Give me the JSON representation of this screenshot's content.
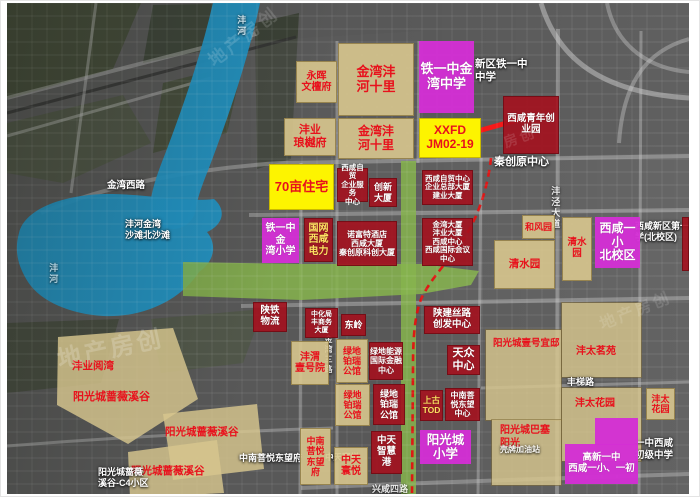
{
  "meta": {
    "title": "金湾片区规划卫星图",
    "width": 700,
    "height": 497
  },
  "colors": {
    "water": "#2293c4",
    "green": "#86b44c",
    "tan_parcel": "#d8c78e",
    "red_parcel": "#a4111e",
    "magenta_school": "#d32fd4",
    "yellow_highlight": "#fdf400",
    "red_text": "#e8111c",
    "dashed_route": "#e31010",
    "arrow": "#f51515",
    "yellow_text": "#ffe162"
  },
  "watermark_text": "地产房创",
  "parcels": [
    {
      "name": "parcel-yonghui-wentanfu",
      "type": "tan",
      "x": 295,
      "y": 60,
      "w": 41,
      "h": 42,
      "fs": 10,
      "text": "永晖\n文檀府"
    },
    {
      "name": "parcel-jinwan-fenghe-shili-north",
      "type": "tan",
      "x": 337,
      "y": 42,
      "w": 76,
      "h": 73,
      "fs": 13,
      "text": "金湾沣\n河十里"
    },
    {
      "name": "parcel-tieyizhong-jinwan-middle-school",
      "type": "magenta",
      "x": 418,
      "y": 40,
      "w": 55,
      "h": 72,
      "fs": 13,
      "text": "铁一中金\n湾中学"
    },
    {
      "name": "parcel-fengye-langyuefu",
      "type": "tan",
      "x": 283,
      "y": 117,
      "w": 52,
      "h": 38,
      "fs": 11,
      "text": "沣业\n琅樾府"
    },
    {
      "name": "parcel-jinwan-fenghe-shili-south",
      "type": "tan",
      "x": 337,
      "y": 117,
      "w": 76,
      "h": 41,
      "fs": 12,
      "text": "金湾沣\n河十里"
    },
    {
      "name": "parcel-xxfd-jm02-19",
      "type": "yellow",
      "x": 418,
      "y": 117,
      "w": 62,
      "h": 40,
      "fs": 12,
      "text": "XXFD\nJM02-19"
    },
    {
      "name": "parcel-xixian-youth-park",
      "type": "red",
      "x": 502,
      "y": 95,
      "w": 56,
      "h": 58,
      "fs": 9.5,
      "text": "西咸青年创\n业园"
    },
    {
      "name": "parcel-70mu-residential",
      "type": "yellow",
      "x": 268,
      "y": 163,
      "w": 65,
      "h": 46,
      "fs": 13,
      "text": "70亩住宅"
    },
    {
      "name": "parcel-zimao-service-center",
      "type": "red",
      "x": 336,
      "y": 167,
      "w": 31,
      "h": 34,
      "fs": 7.5,
      "text": "西咸自贸\n企业服务\n中心"
    },
    {
      "name": "parcel-chuangxin-tower",
      "type": "red",
      "x": 368,
      "y": 177,
      "w": 28,
      "h": 29,
      "fs": 9,
      "text": "创新\n大厦"
    },
    {
      "name": "parcel-zimao-center",
      "type": "red",
      "x": 421,
      "y": 169,
      "w": 51,
      "h": 35,
      "fs": 7.5,
      "text": "西咸自贸中心\n企业总部大厦\n建业大厦"
    },
    {
      "name": "parcel-tieyizhong-jinwan-primary",
      "type": "magenta",
      "x": 261,
      "y": 217,
      "w": 37,
      "h": 45,
      "fs": 10,
      "text": "铁一中金\n湾小学"
    },
    {
      "name": "parcel-guowang-xixian-power",
      "type": "red",
      "x": 303,
      "y": 217,
      "w": 29,
      "h": 44,
      "fs": 10,
      "tc": "#ffe162",
      "text": "国网\n西咸\n电力"
    },
    {
      "name": "parcel-novotel-block",
      "type": "red",
      "x": 336,
      "y": 220,
      "w": 60,
      "h": 45,
      "fs": 8,
      "text": "诺富特酒店\n西咸大厦\n秦创原科创大厦"
    },
    {
      "name": "parcel-jinwan-tower-block",
      "type": "red",
      "x": 421,
      "y": 217,
      "w": 51,
      "h": 48,
      "fs": 7.5,
      "text": "金湾大厦\n沣业大厦\n西咸中心\n西咸国际会议中心"
    },
    {
      "name": "parcel-hefengyuan",
      "type": "tan",
      "x": 521,
      "y": 214,
      "w": 33,
      "h": 24,
      "fs": 9,
      "text": "和风园"
    },
    {
      "name": "parcel-qingshuiyuan-west",
      "type": "tan",
      "x": 493,
      "y": 239,
      "w": 61,
      "h": 49,
      "fs": 10.5,
      "text": "清水园"
    },
    {
      "name": "parcel-qingshuiyuan-east",
      "type": "tan",
      "x": 561,
      "y": 216,
      "w": 30,
      "h": 64,
      "fs": 9.5,
      "text": "清水园"
    },
    {
      "name": "parcel-xixian-yixiao-north-campus",
      "type": "magenta",
      "x": 594,
      "y": 216,
      "w": 45,
      "h": 51,
      "fs": 12,
      "text": "西咸一小\n北校区"
    },
    {
      "name": "parcel-shaantie-logistics",
      "type": "red",
      "x": 252,
      "y": 301,
      "w": 34,
      "h": 30,
      "fs": 9.5,
      "text": "陕铁\n物流"
    },
    {
      "name": "parcel-zhonghuaju-tower",
      "type": "red",
      "x": 304,
      "y": 307,
      "w": 33,
      "h": 30,
      "fs": 7,
      "text": "中化局\n丰商务\n大厦"
    },
    {
      "name": "parcel-dongling",
      "type": "red",
      "x": 340,
      "y": 313,
      "w": 25,
      "h": 22,
      "fs": 9,
      "text": "东岭"
    },
    {
      "name": "parcel-fengwei-yihaoyuan",
      "type": "tan",
      "x": 290,
      "y": 340,
      "w": 38,
      "h": 44,
      "fs": 10,
      "text": "沣渭\n壹号院"
    },
    {
      "name": "parcel-lvdi-borui-1",
      "type": "tan",
      "x": 335,
      "y": 338,
      "w": 32,
      "h": 44,
      "fs": 9,
      "text": "绿地\n铂瑞\n公馆"
    },
    {
      "name": "parcel-lvdi-energy-center",
      "type": "red",
      "x": 368,
      "y": 341,
      "w": 34,
      "h": 38,
      "fs": 8,
      "text": "绿地能源\n国际金融\n中心"
    },
    {
      "name": "parcel-lvdi-borui-2",
      "type": "tan",
      "x": 334,
      "y": 383,
      "w": 35,
      "h": 42,
      "fs": 9,
      "text": "绿地\n铂瑞\n公馆"
    },
    {
      "name": "parcel-lvdi-borui-3",
      "type": "red",
      "x": 372,
      "y": 383,
      "w": 32,
      "h": 41,
      "fs": 9,
      "text": "绿地\n铂瑞\n公馆"
    },
    {
      "name": "parcel-shaanjian-silu-center",
      "type": "red",
      "x": 423,
      "y": 305,
      "w": 56,
      "h": 28,
      "fs": 9.5,
      "text": "陕建丝路\n创发中心"
    },
    {
      "name": "parcel-tianzhong-center",
      "type": "red",
      "x": 446,
      "y": 344,
      "w": 33,
      "h": 30,
      "fs": 11,
      "text": "天众\n中心"
    },
    {
      "name": "parcel-shanggu-tod",
      "type": "red",
      "x": 419,
      "y": 389,
      "w": 23,
      "h": 31,
      "fs": 8.5,
      "tc": "#ffe162",
      "text": "上古\nTOD"
    },
    {
      "name": "parcel-zhongnan-puyue-center",
      "type": "red",
      "x": 444,
      "y": 387,
      "w": 35,
      "h": 33,
      "fs": 8,
      "text": "中南菩\n悦东望\n中心"
    },
    {
      "name": "parcel-zhongnan-puyue-dongwangfu",
      "type": "tan",
      "x": 299,
      "y": 427,
      "w": 31,
      "h": 57,
      "fs": 9,
      "text": "中南\n菩悦\n东望\n府"
    },
    {
      "name": "parcel-zhongtian-huanyue",
      "type": "tan",
      "x": 333,
      "y": 446,
      "w": 34,
      "h": 38,
      "fs": 10,
      "text": "中天\n寰悦"
    },
    {
      "name": "parcel-zhongtian-zhihuigang",
      "type": "red",
      "x": 370,
      "y": 430,
      "w": 31,
      "h": 43,
      "fs": 9.5,
      "text": "中天\n智慧\n港"
    },
    {
      "name": "parcel-yangguangcheng-primary",
      "type": "magenta",
      "x": 419,
      "y": 429,
      "w": 51,
      "h": 34,
      "fs": 12.5,
      "text": "阳光城\n小学"
    },
    {
      "name": "parcel-fengtai-huayuan-east",
      "type": "tan",
      "x": 645,
      "y": 387,
      "w": 29,
      "h": 32,
      "fs": 9,
      "text": "沣太\n花园"
    },
    {
      "name": "parcel-gaoxin-school-top",
      "type": "magenta",
      "x": 594,
      "y": 417,
      "w": 43,
      "h": 27,
      "fs": 9,
      "text": ""
    },
    {
      "name": "parcel-gaoxin-yizhong-school",
      "type": "magenta",
      "x": 564,
      "y": 443,
      "w": 73,
      "h": 40,
      "fs": 9.5,
      "text": "高新一中\n西咸一小、一初"
    },
    {
      "name": "parcel-right-edge-sliver",
      "type": "red",
      "x": 681,
      "y": 216,
      "w": 7,
      "h": 54,
      "fs": 7,
      "text": ""
    }
  ],
  "zones": [
    {
      "name": "zone-yihao-yidi-parcel",
      "x": 485,
      "y": 329,
      "w": 75,
      "h": 90
    },
    {
      "name": "zone-fengtai-mingyuan-parcel",
      "x": 561,
      "y": 302,
      "w": 79,
      "h": 74
    },
    {
      "name": "zone-fengtai-huayuan-parcel",
      "x": 561,
      "y": 387,
      "w": 79,
      "h": 73
    },
    {
      "name": "zone-basai-parcel",
      "x": 491,
      "y": 419,
      "w": 69,
      "h": 65
    },
    {
      "name": "zone-qiangwei-1",
      "x": 56,
      "y": 327,
      "w": 141,
      "h": 116,
      "clip": "0.7% 7.8%, 82.3% 0%, 100% 61.2%, 50.4% 100%, 0% 66.4%"
    },
    {
      "name": "zone-qiangwei-2",
      "x": 162,
      "y": 403,
      "w": 101,
      "h": 76,
      "clip": "0% 13.2%, 93.1% 0%, 100% 85.5%, 9.9% 100%"
    },
    {
      "name": "zone-qiangwei-3",
      "x": 127,
      "y": 439,
      "w": 96,
      "h": 58,
      "clip": "0% 20.7%, 92.7% 0%, 100% 91.4%, 2.1% 100%"
    }
  ],
  "labels": [
    {
      "name": "label-yihao-yidi",
      "color": "red",
      "x": 492,
      "y": 337,
      "fs": 9.5,
      "text": "阳光城壹号宜邸"
    },
    {
      "name": "label-fengtai-mingyuan",
      "color": "red",
      "x": 575,
      "y": 345,
      "fs": 10,
      "text": "沣太茗苑"
    },
    {
      "name": "label-fengtai-huayuan",
      "color": "red",
      "x": 574,
      "y": 397,
      "fs": 10,
      "text": "沣太花园"
    },
    {
      "name": "label-basai-yangguang",
      "color": "red",
      "x": 499,
      "y": 424,
      "fs": 10,
      "text": "阳光城巴塞\n阳光"
    },
    {
      "name": "label-fengye-yuewan",
      "color": "red",
      "x": 71,
      "y": 359,
      "fs": 10.5,
      "text": "沣业阅湾"
    },
    {
      "name": "label-qiangwei-xigu-1",
      "color": "red",
      "x": 72,
      "y": 390,
      "fs": 11,
      "text": "阳光城蔷薇溪谷"
    },
    {
      "name": "label-qiangwei-xigu-2",
      "color": "red",
      "x": 164,
      "y": 425,
      "fs": 10.5,
      "text": "阳光城蔷薇溪谷"
    },
    {
      "name": "label-qiangwei-xigu-3",
      "color": "red",
      "x": 130,
      "y": 464,
      "fs": 10.5,
      "text": "阳光城蔷薇溪谷"
    },
    {
      "name": "maptext-jinwan-xilu-road",
      "color": "white",
      "x": 106,
      "y": 179,
      "fs": 9.5,
      "text": "金湾西路"
    },
    {
      "name": "maptext-fenghe-jinwan-beach",
      "color": "white",
      "x": 124,
      "y": 218,
      "fs": 9,
      "text": "沣河金湾\n沙滩北沙滩"
    },
    {
      "name": "maptext-lake-fenghe",
      "color": "white",
      "vert": true,
      "op": 0.65,
      "x": 46,
      "y": 262,
      "fs": 9,
      "text": "沣河"
    },
    {
      "name": "maptext-river-fenghe",
      "color": "white",
      "vert": true,
      "op": 0.75,
      "x": 234,
      "y": 14,
      "fs": 9,
      "text": "沣河"
    },
    {
      "name": "maptext-xinqu-tieyizhong",
      "color": "white",
      "x": 474,
      "y": 57,
      "fs": 10.5,
      "text": "新区铁一中\n中学"
    },
    {
      "name": "maptext-qinchuangyuan-center",
      "color": "white",
      "x": 493,
      "y": 155,
      "fs": 11,
      "text": "秦创原中心"
    },
    {
      "name": "maptext-xixian-primary-bg",
      "color": "white",
      "x": 634,
      "y": 220,
      "fs": 9,
      "text": "西咸新区第一小\n学(北校区)"
    },
    {
      "name": "maptext-zhongnan-dongwangfu-bg",
      "color": "white",
      "x": 238,
      "y": 452,
      "fs": 9,
      "text": "中南菩悦东望府"
    },
    {
      "name": "maptext-qiangwei-c4",
      "color": "white",
      "x": 97,
      "y": 466,
      "fs": 9,
      "text": "阳光城蔷薇\n溪谷-C4小区"
    },
    {
      "name": "maptext-zhongtian-huanyue-bg",
      "color": "white",
      "x": 324,
      "y": 451,
      "fs": 8.5,
      "text": "中天寰悦"
    },
    {
      "name": "maptext-yizhong-xixian-junior",
      "color": "white",
      "x": 634,
      "y": 437,
      "fs": 9.5,
      "text": "一中西咸\n初级中学"
    },
    {
      "name": "maptext-shell-station",
      "color": "white",
      "op": 0.9,
      "x": 499,
      "y": 444,
      "fs": 8,
      "text": "壳牌加油站"
    },
    {
      "name": "maptext-fengti-road",
      "color": "white",
      "x": 566,
      "y": 376,
      "fs": 9,
      "text": "丰梯路"
    },
    {
      "name": "maptext-xingxian-road",
      "color": "white",
      "op": 0.85,
      "x": 371,
      "y": 483,
      "fs": 9,
      "text": "兴咸四路"
    },
    {
      "name": "maptext-jinwan-sanlu-road",
      "color": "white",
      "vert": true,
      "op": 0.85,
      "x": 322,
      "y": 334,
      "fs": 8,
      "text": "金湾三路"
    },
    {
      "name": "maptext-fengjing-avenue",
      "color": "white",
      "vert": true,
      "op": 0.85,
      "x": 548,
      "y": 185,
      "fs": 9,
      "text": "沣泾大道"
    }
  ],
  "watermarks": [
    {
      "name": "watermark-1",
      "x": 55,
      "y": 328,
      "fs": 24,
      "rot": -12,
      "op": 0.45,
      "text": "地产房创"
    },
    {
      "name": "watermark-2",
      "x": 200,
      "y": 22,
      "fs": 18,
      "rot": -38,
      "op": 0.35,
      "text": "地产房创"
    },
    {
      "name": "watermark-3",
      "x": 596,
      "y": 296,
      "fs": 16,
      "rot": -22,
      "op": 0.3,
      "text": "地产房创"
    },
    {
      "name": "watermark-4",
      "x": 502,
      "y": 126,
      "fs": 14,
      "rot": -20,
      "op": 0.3,
      "text": "房创"
    }
  ]
}
